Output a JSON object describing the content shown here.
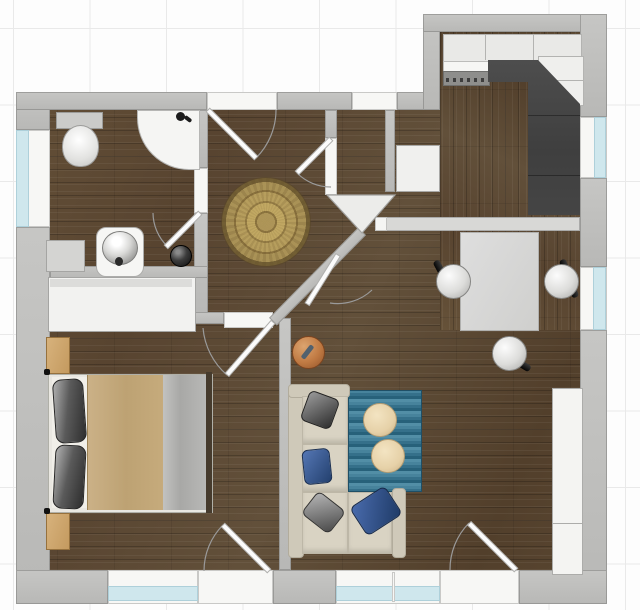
{
  "app": {
    "type": "floor-plan-viewer",
    "visible_text": "none"
  },
  "floorplan": {
    "rooms": [
      {
        "name": "bathroom",
        "items": {
          "toilet": "toilet",
          "shower": "corner shower",
          "sink": "washbasin",
          "cabinet": "bathroom cabinet",
          "canister": "canister"
        }
      },
      {
        "name": "hallway",
        "items": {
          "rug": "round ornament rug"
        }
      },
      {
        "name": "kitchen",
        "items": {
          "cabinets": "upper cabinet row",
          "counter": "L-shaped dark worktop",
          "sink": "kitchen sink",
          "dishwasher": "dishwasher"
        }
      },
      {
        "name": "dining-area",
        "items": {
          "table": "dining table",
          "chairs": "3 chairs",
          "half_wall": "half wall"
        }
      },
      {
        "name": "living-room",
        "items": {
          "sofa": "corner sofa",
          "rug": "blue striped rug",
          "poufs": "2 round poufs",
          "stool": "metal stool",
          "sideboard": "sideboard",
          "builtins": "built-in wardrobe"
        }
      },
      {
        "name": "bedroom",
        "items": {
          "bed": "double bed",
          "nightstands": "2 nightstands",
          "wardrobe": "wardrobe"
        }
      }
    ],
    "openings": {
      "doors": 7,
      "windows": 6
    },
    "colors": {
      "wall": "#c2c2c0",
      "floor_wood": "#5b4833",
      "window_glass": "#cfe7ed",
      "counter": "#454545",
      "sofa": "#d9d3c3",
      "rug_blue": "#35708a",
      "rug_round_gold": "#b89d58",
      "pillow_blue": "#3c5d9e",
      "stool_copper": "#c07a43",
      "blanket": "#c4a97d"
    }
  }
}
